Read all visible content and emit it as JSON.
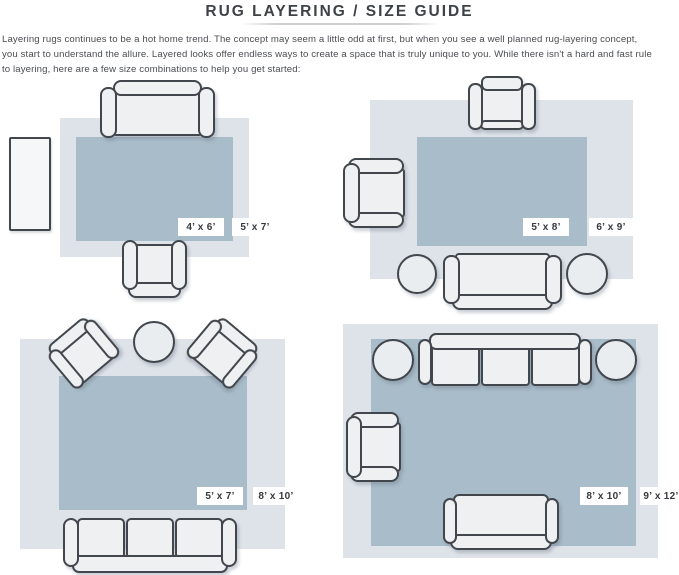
{
  "header": {
    "title": "RUG LAYERING / SIZE GUIDE",
    "intro_lines": [
      "Layering rugs continues to be a hot home trend. The concept may seem a little odd at first, but when you see a well planned rug-layering concept,",
      "you start to understand the allure. Layered looks offer endless ways to create a space that is truly unique to you. While there isn't a hard and fast rule",
      "to layering, here are a few size combinations to help you get started:"
    ]
  },
  "colors": {
    "rug_outer": "#dee3e9",
    "rug_inner": "#a9bcc9",
    "furniture_fill": "#eef0f2",
    "furniture_outline": "#42474d",
    "text": "#4a4d51"
  },
  "diagrams": [
    {
      "name": "top-left",
      "inner_rug_size": "4’ x 6’",
      "outer_rug_size": "5’ x 7’",
      "furniture": [
        "sofa",
        "armchair",
        "side-table"
      ]
    },
    {
      "name": "top-right",
      "inner_rug_size": "5’ x 8’",
      "outer_rug_size": "6’ x 9’",
      "furniture": [
        "armchair",
        "armchair",
        "sofa",
        "round-pouf",
        "round-pouf"
      ]
    },
    {
      "name": "bottom-left",
      "inner_rug_size": "5’ x 7’",
      "outer_rug_size": "8’ x 10’",
      "furniture": [
        "armchair",
        "armchair",
        "round-table",
        "three-seat-sofa"
      ]
    },
    {
      "name": "bottom-right",
      "inner_rug_size": "8’ x 10’",
      "outer_rug_size": "9’ x 12’",
      "furniture": [
        "three-seat-sofa",
        "round-pouf",
        "round-pouf",
        "armchair",
        "loveseat"
      ]
    }
  ]
}
